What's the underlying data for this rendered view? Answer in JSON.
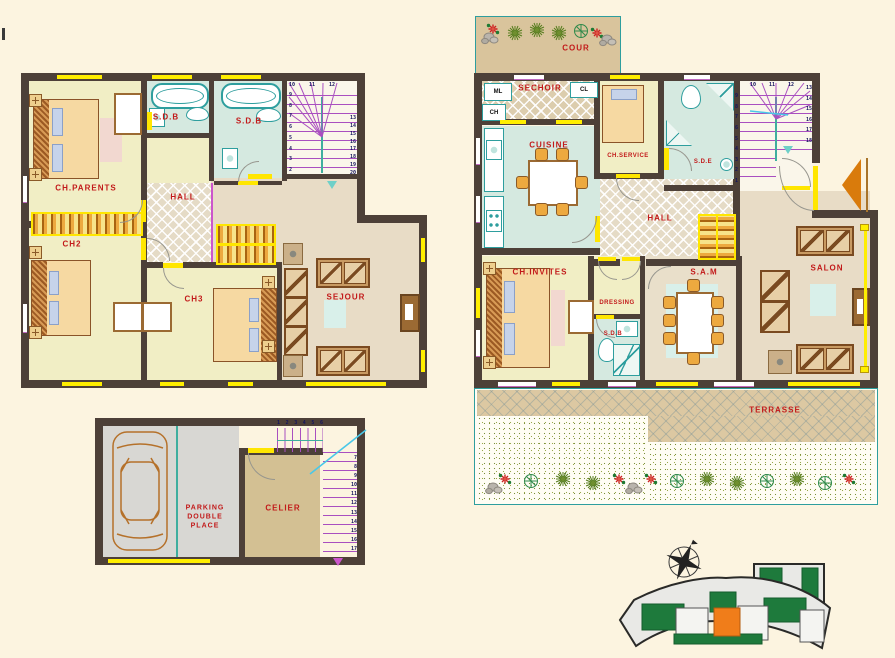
{
  "colors": {
    "background": "#fcf4e0",
    "wall": "#4d4038",
    "label_red": "#c21a1a",
    "room_yellow": "#f1eec5",
    "room_cyan": "#d5e9e0",
    "room_beige": "#e8dcc6",
    "window_yellow": "#ffee00",
    "stair_purple": "#a94fc0",
    "stair_teal": "#3fae9e",
    "terrace_tan": "#dcc8a2",
    "parking_gray": "#d8d7d3",
    "celier_tan": "#d3c093",
    "entry_arrow_orange": "#d97b0c",
    "site_highlight_orange": "#f07d1a",
    "site_green": "#1e7a3c"
  },
  "floor_upper": {
    "rooms": {
      "ch_parents": "CH.PARENTS",
      "sdb_left": "S.D.B",
      "sdb_right": "S.D.B",
      "hall": "HALL",
      "ch2": "CH2",
      "ch3": "CH3",
      "sejour": "SEJOUR"
    },
    "stairs": {
      "fan": [
        "10",
        "11",
        "12"
      ],
      "left_run": [
        "9",
        "8",
        "7",
        "6",
        "5",
        "4",
        "3",
        "2"
      ],
      "right_run": [
        "13",
        "14",
        "15",
        "16",
        "17",
        "18",
        "19",
        "20"
      ]
    }
  },
  "floor_ground": {
    "rooms": {
      "cour": "COUR",
      "sechoir": "SECHOIR",
      "ml": "ML",
      "cl": "CL",
      "ch": "CH",
      "cuisine": "CUISINE",
      "ch_service": "CH.SERVICE",
      "sde": "S.D.E",
      "hall": "HALL",
      "ch_invites": "CH.INVITES",
      "dressing": "DRESSING",
      "sdb": "S.D.B",
      "sam": "S.A.M",
      "salon": "SALON",
      "terrasse": "TERRASSE"
    },
    "stairs": {
      "left_run": [
        "9",
        "8",
        "7",
        "6",
        "5",
        "4",
        "3",
        "2",
        "1"
      ],
      "fan": [
        "10",
        "11",
        "12"
      ],
      "right_run": [
        "13",
        "14",
        "15",
        "16",
        "17",
        "18"
      ]
    }
  },
  "basement": {
    "rooms": {
      "parking_lines": [
        "PARKING",
        "DOUBLE",
        "PLACE"
      ],
      "celier": "CELIER"
    },
    "stairs": {
      "top_run": [
        "1",
        "2",
        "3",
        "4",
        "5",
        "6"
      ],
      "right_run": [
        "7",
        "8",
        "9",
        "10",
        "11",
        "12",
        "13",
        "14",
        "15",
        "16",
        "17"
      ]
    }
  }
}
